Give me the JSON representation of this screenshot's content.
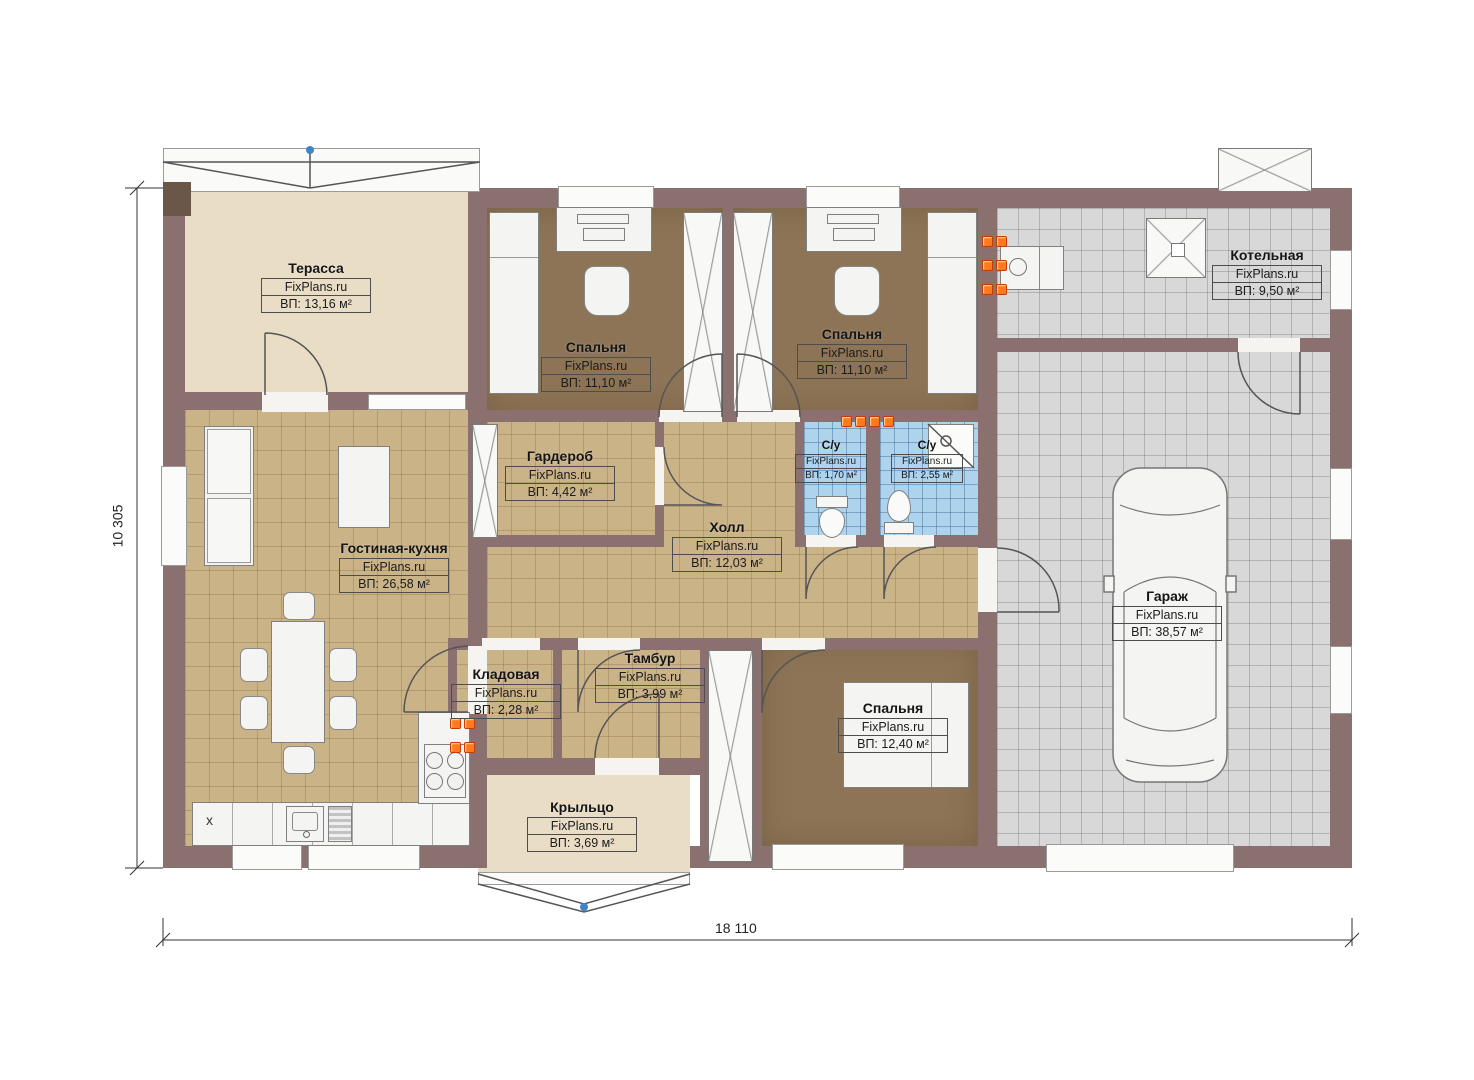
{
  "plan": {
    "watermark": "FixPlans.ru",
    "dim_width": "18 110",
    "dim_height": "10 305",
    "kitchen_marker": "x",
    "colors": {
      "wall": "#8b7070",
      "terrace_floor": "#e9ddc6",
      "tile_floor": "#cbb388",
      "carpet_floor": "#8d7456",
      "garage_floor": "#d8d8d8",
      "bathroom_floor": "#aed3ec",
      "radiator_orange": "#ff7a1e",
      "marker_blue": "#3f86c9"
    },
    "rooms": [
      {
        "id": "terrace",
        "name": "Терасса",
        "watermark": "FixPlans.ru",
        "area": "ВП: 13,16 м²"
      },
      {
        "id": "bedroom-1",
        "name": "Спальня",
        "watermark": "FixPlans.ru",
        "area": "ВП: 11,10 м²"
      },
      {
        "id": "bedroom-2",
        "name": "Спальня",
        "watermark": "FixPlans.ru",
        "area": "ВП: 11,10 м²"
      },
      {
        "id": "boiler-room",
        "name": "Котельная",
        "watermark": "FixPlans.ru",
        "area": "ВП: 9,50 м²"
      },
      {
        "id": "wardrobe-room",
        "name": "Гардероб",
        "watermark": "FixPlans.ru",
        "area": "ВП: 4,42 м²"
      },
      {
        "id": "hall",
        "name": "Холл",
        "watermark": "FixPlans.ru",
        "area": "ВП: 12,03 м²"
      },
      {
        "id": "wc-1",
        "name": "С/у",
        "watermark": "FixPlans.ru",
        "area": "ВП: 1,70 м²"
      },
      {
        "id": "wc-2",
        "name": "С/у",
        "watermark": "FixPlans.ru",
        "area": "ВП: 2,55 м²"
      },
      {
        "id": "living-kitchen",
        "name": "Гостиная-кухня",
        "watermark": "FixPlans.ru",
        "area": "ВП: 26,58 м²"
      },
      {
        "id": "garage",
        "name": "Гараж",
        "watermark": "FixPlans.ru",
        "area": "ВП: 38,57 м²"
      },
      {
        "id": "pantry",
        "name": "Кладовая",
        "watermark": "FixPlans.ru",
        "area": "ВП: 2,28 м²"
      },
      {
        "id": "vestibule",
        "name": "Тамбур",
        "watermark": "FixPlans.ru",
        "area": "ВП: 3,99 м²"
      },
      {
        "id": "bedroom-3",
        "name": "Спальня",
        "watermark": "FixPlans.ru",
        "area": "ВП: 12,40 м²"
      },
      {
        "id": "porch",
        "name": "Крыльцо",
        "watermark": "FixPlans.ru",
        "area": "ВП: 3,69 м²"
      }
    ]
  }
}
